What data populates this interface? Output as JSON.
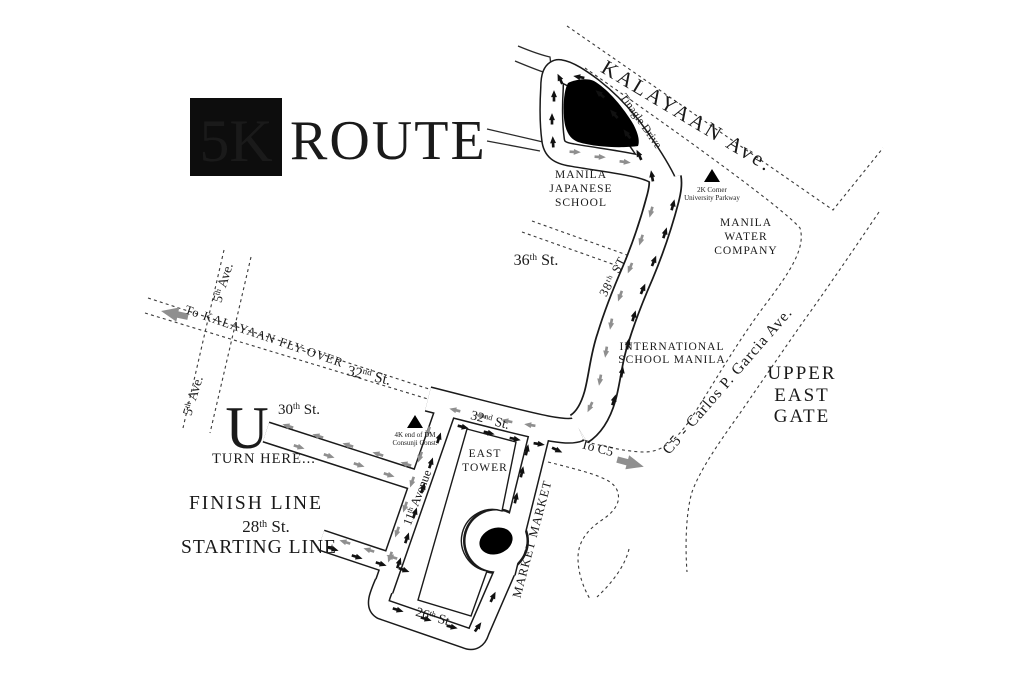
{
  "title": {
    "badge": "5K",
    "word": "ROUTE"
  },
  "streets": {
    "kalayaan": "KALAYAAN Ave.",
    "tinagle": "Tinagle Drive",
    "st38": {
      "num": "38",
      "sup": "th",
      "rest": " ST."
    },
    "st36": {
      "num": "36",
      "sup": "th",
      "rest": " St."
    },
    "st32_mid": {
      "num": "32",
      "sup": "nd",
      "rest": " St."
    },
    "st32_west": {
      "num": "32",
      "sup": "nd",
      "rest": " St."
    },
    "st30": {
      "num": "30",
      "sup": "th",
      "rest": " St."
    },
    "st28": {
      "num": "28",
      "sup": "th",
      "rest": " St."
    },
    "st26": {
      "num": "26",
      "sup": "th",
      "rest": " St."
    },
    "ave11": {
      "num": "11",
      "sup": "th",
      "rest": " Avenue"
    },
    "ave5_upper": {
      "num": "5",
      "sup": "th",
      "rest": " Ave."
    },
    "ave5_lower": {
      "num": "5",
      "sup": "th",
      "rest": " Ave."
    },
    "c5": "C5 - Carlos P. Garcia Ave.",
    "to_kalayaan": "To KALAYAAN FLY-OVER",
    "to_c5": "To C5",
    "market_market": "MARKET MARKET"
  },
  "places": {
    "manila_japanese_school": [
      "MANILA",
      "JAPANESE",
      "SCHOOL"
    ],
    "manila_water": [
      "MANILA",
      "WATER",
      "COMPANY"
    ],
    "ism": [
      "INTERNATIONAL",
      "SCHOOL MANILA"
    ],
    "upper_east_gate": [
      "UPPER",
      "EAST",
      "GATE"
    ],
    "east_tower": [
      "EAST",
      "TOWER"
    ]
  },
  "markers": {
    "k2": {
      "line1": "2K Corner",
      "line2": "University Parkway"
    },
    "k4": {
      "line1": "4K end of DM",
      "line2": "Consunji Const."
    }
  },
  "annotations": {
    "uturn_u": "U",
    "uturn_caption": "TURN HERE...",
    "finish": "FINISH LINE",
    "start": "STARTING LINE"
  },
  "colors": {
    "outbound_arrow": "#111111",
    "return_arrow": "#8f8f8f",
    "faint_label": "#a8a8a8",
    "mid_label": "#555555"
  }
}
